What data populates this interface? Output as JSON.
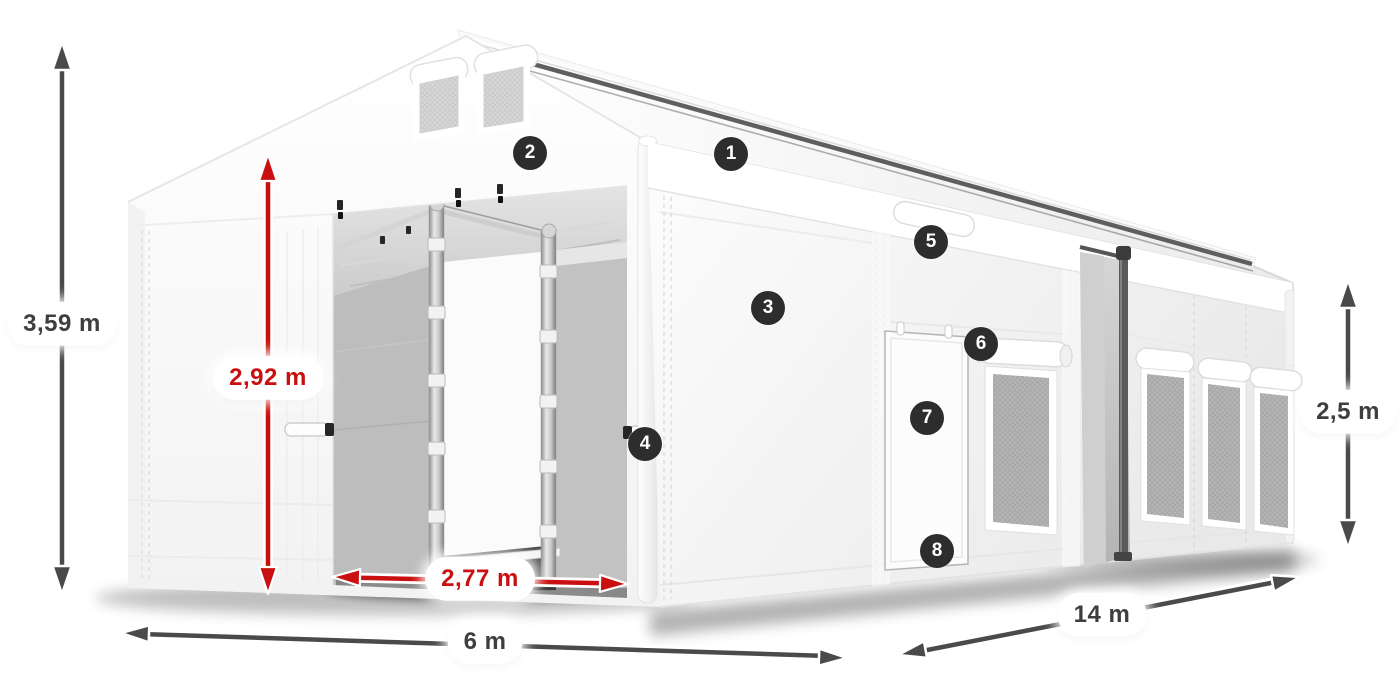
{
  "diagram": {
    "colors": {
      "dimension_dark": "#4a4a4a",
      "dimension_red": "#c90f0f",
      "badge_background": "#2d2d2d",
      "badge_text": "#ffffff",
      "label_text_dark": "#3e3e3e",
      "tent_white": "#ffffff"
    },
    "dimensions": [
      {
        "id": "total-height",
        "label": "3,59 m",
        "style": "dark",
        "orientation": "vertical"
      },
      {
        "id": "entrance-height",
        "label": "2,92 m",
        "style": "red",
        "orientation": "vertical"
      },
      {
        "id": "entrance-width",
        "label": "2,77 m",
        "style": "red",
        "orientation": "horizontal"
      },
      {
        "id": "front-width",
        "label": "6 m",
        "style": "dark",
        "orientation": "horizontal"
      },
      {
        "id": "side-length",
        "label": "14 m",
        "style": "dark",
        "orientation": "diagonal"
      },
      {
        "id": "side-height",
        "label": "2,5 m",
        "style": "dark",
        "orientation": "vertical"
      }
    ],
    "callouts": [
      {
        "number": "1"
      },
      {
        "number": "2"
      },
      {
        "number": "3"
      },
      {
        "number": "4"
      },
      {
        "number": "5"
      },
      {
        "number": "6"
      },
      {
        "number": "7"
      },
      {
        "number": "8"
      }
    ]
  }
}
